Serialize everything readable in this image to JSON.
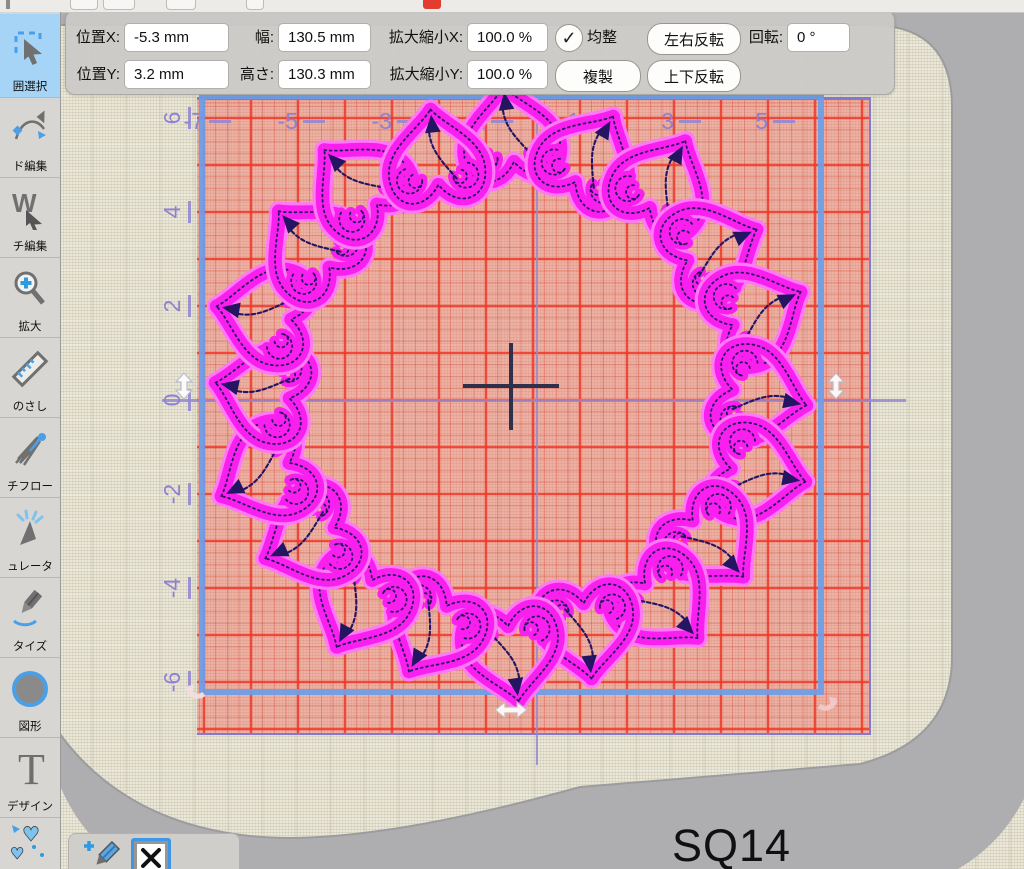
{
  "toolbar": {
    "fields": [
      {
        "id": "pos_x",
        "label": "位置X:",
        "value": "-5.3 mm"
      },
      {
        "id": "width",
        "label": "幅:",
        "value": "130.5 mm"
      },
      {
        "id": "scale_x",
        "label": "拡大縮小X:",
        "value": "100.0 %"
      },
      {
        "id": "pos_y",
        "label": "位置Y:",
        "value": "3.2 mm"
      },
      {
        "id": "height",
        "label": "高さ:",
        "value": "130.3 mm"
      },
      {
        "id": "scale_y",
        "label": "拡大縮小Y:",
        "value": "100.0 %"
      },
      {
        "id": "rotation",
        "label": "回転:",
        "value": "0 °"
      }
    ],
    "checkbox": {
      "label": "均整",
      "checked": true,
      "check_glyph": "✓"
    },
    "buttons": [
      {
        "id": "flip_horizontal",
        "label": "左右反転"
      },
      {
        "id": "duplicate",
        "label": "複製"
      },
      {
        "id": "flip_vertical",
        "label": "上下反転"
      }
    ]
  },
  "sidebar": {
    "items": [
      {
        "id": "range-select",
        "label": "囲選択",
        "selected": true
      },
      {
        "id": "node-edit",
        "label": "ド編集",
        "selected": false
      },
      {
        "id": "stitch-edit",
        "label": "チ編集",
        "selected": false
      },
      {
        "id": "zoom",
        "label": "拡大",
        "selected": false
      },
      {
        "id": "ruler",
        "label": "のさし",
        "selected": false
      },
      {
        "id": "stitch-flow",
        "label": "チフロー",
        "selected": false
      },
      {
        "id": "simulator",
        "label": "ュレータ",
        "selected": false
      },
      {
        "id": "digitize",
        "label": "タイズ",
        "selected": false
      },
      {
        "id": "shape",
        "label": "図形",
        "selected": false
      },
      {
        "id": "text-design",
        "label": "デザイン",
        "selected": false
      },
      {
        "id": "heart-design",
        "label": "",
        "selected": false
      }
    ]
  },
  "canvas": {
    "hoop_label": "SQ14",
    "ruler": {
      "top_labels": [
        -7,
        -5,
        -3,
        -1,
        1,
        3,
        5
      ],
      "left_labels": [
        6,
        4,
        2,
        0,
        -2,
        -4,
        -6
      ],
      "cm_px": 47
    },
    "design": {
      "type": "heart-chain-ring",
      "count": 20,
      "cx": 451,
      "cy": 382,
      "radius": 248,
      "scale": 1.05,
      "thread_color": "#f91fee",
      "glow_color": "#ff79f7",
      "detail_color": "#241563"
    }
  },
  "colors": {
    "selection_blue": "#6ca0e9",
    "grid_red": "#f43424",
    "grid_purple": "#8f80d2",
    "hoop_gray": "#aeaeb1",
    "fabric": "#eae7d7",
    "tool_selected": "#a5d4f6",
    "accent_blue": "#4aa0e8"
  },
  "icons": {
    "check": "✓",
    "x_mark": "✕",
    "heart": "♥"
  }
}
